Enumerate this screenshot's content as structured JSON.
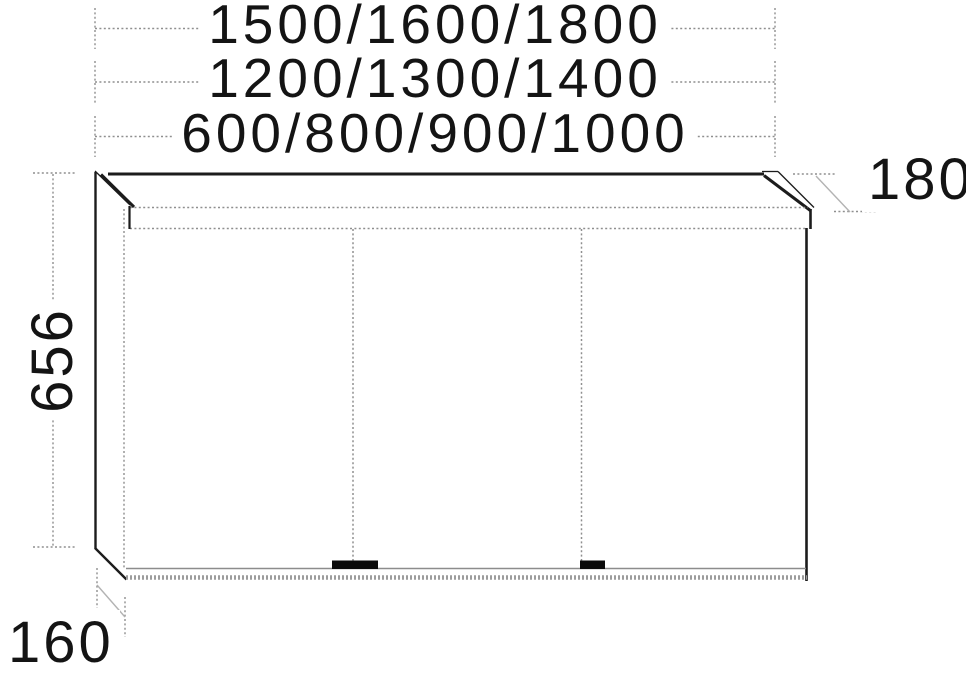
{
  "drawing": {
    "kind": "mirror-cabinet-dimension-diagram",
    "labels": {
      "width_row1": "1500/1600/1800",
      "width_row2": "1200/1300/1400",
      "width_row3": "600/800/900/1000",
      "height": "656",
      "canopy_depth": "180",
      "base_depth": "160"
    },
    "colors": {
      "solid_line": "#1c1c1c",
      "dotted_line": "#8f8f8f",
      "thin_gray_line": "#b3b3b3",
      "bottom_band": "#9c9c9c",
      "handle": "#0a0a0a",
      "text": "#141414",
      "background": "#ffffff"
    }
  }
}
